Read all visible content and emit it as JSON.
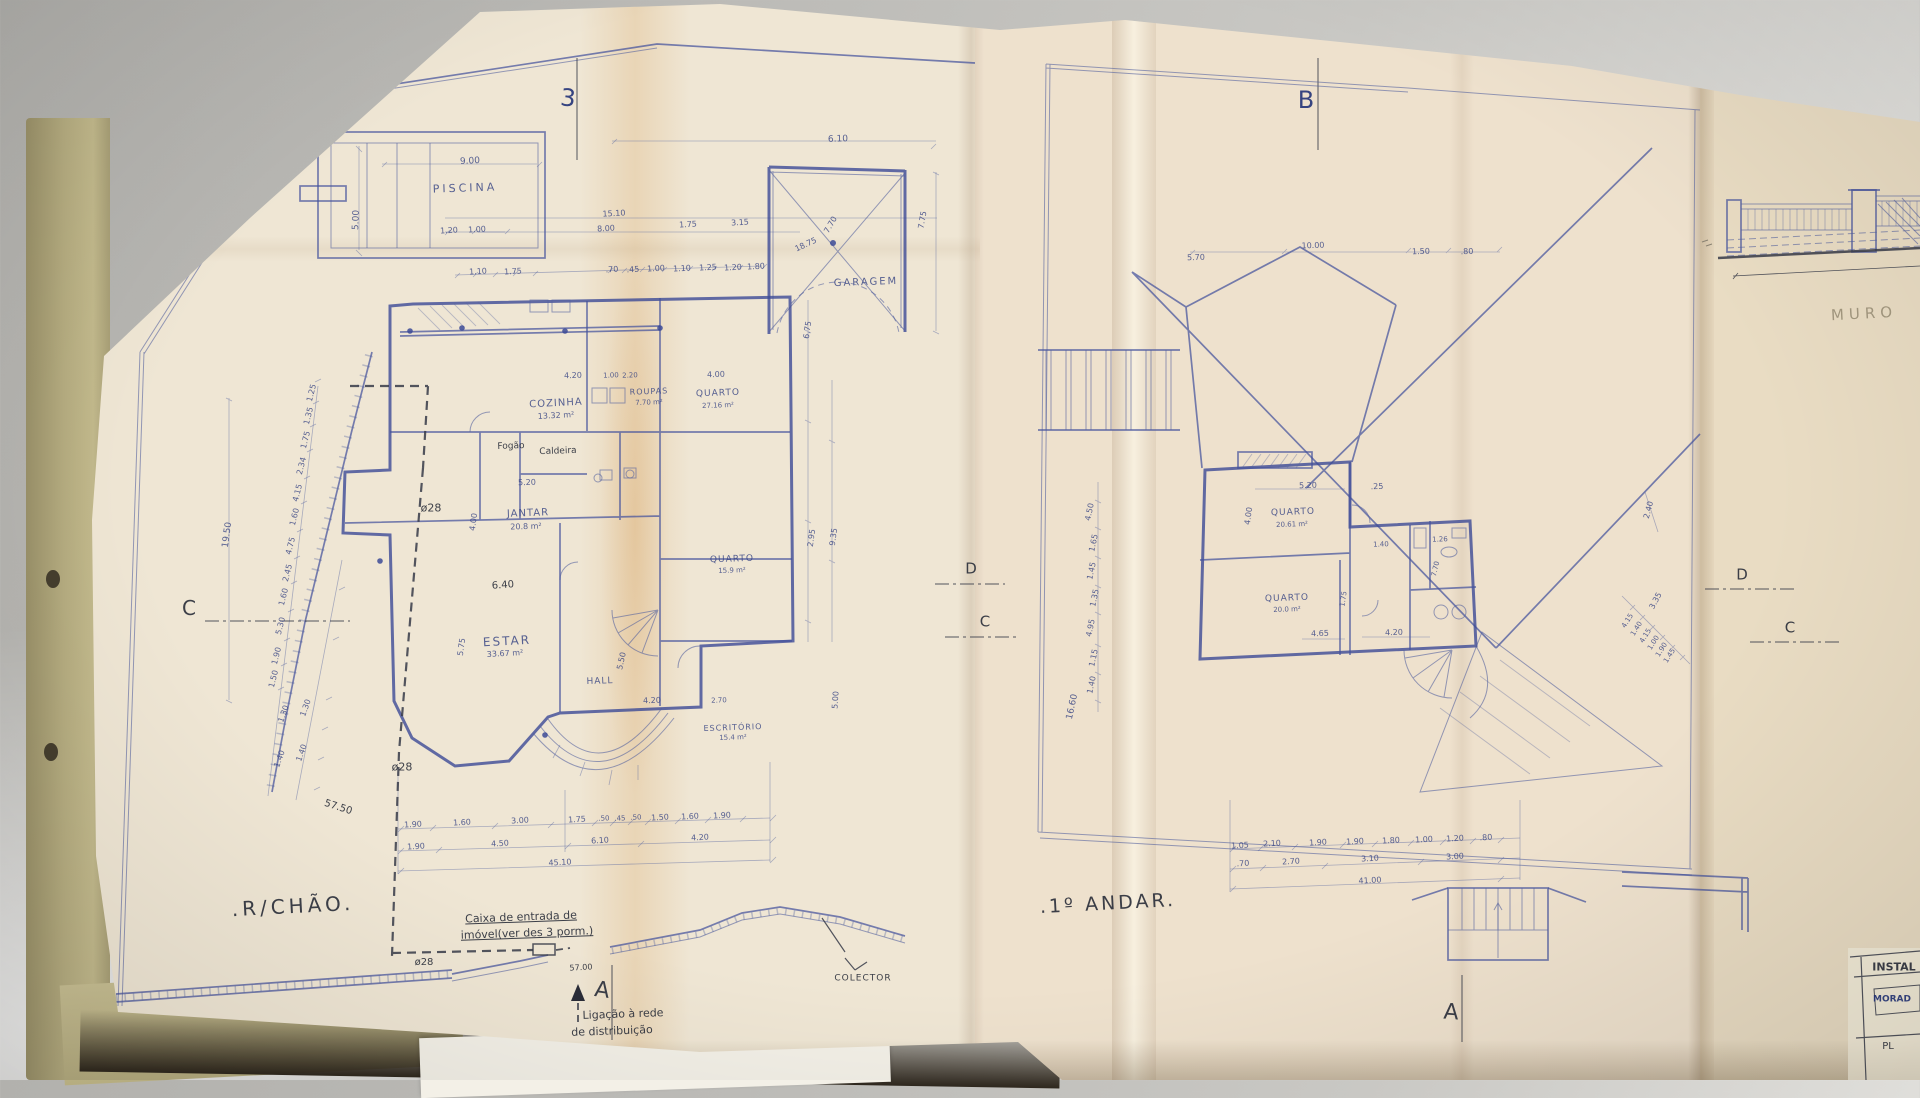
{
  "palette": {
    "paper": "#efe6d4",
    "ink_blue": "#3c4a96",
    "pen_dark": "#2a2c38",
    "fold_tint": "#d29646",
    "desk": "#c9c8c4"
  },
  "sheets": {
    "left_plan_title": ".R/CHÃO.",
    "right_plan_title": ".1º ANDAR.",
    "far_right_note": "MURO"
  },
  "annotations": [
    {
      "t": "3",
      "x": 568,
      "y": 98,
      "s": 24,
      "r": 6,
      "c": "ink2",
      "n": "section-marker-3"
    },
    {
      "t": "PISCINA",
      "x": 465,
      "y": 188,
      "s": 11,
      "r": -2,
      "ls": 3,
      "n": "room-label-piscina"
    },
    {
      "t": "9.00",
      "x": 470,
      "y": 162,
      "s": 9,
      "r": -3
    },
    {
      "t": "5.00",
      "x": 357,
      "y": 220,
      "s": 9,
      "r": -88
    },
    {
      "t": "1.20",
      "x": 449,
      "y": 231,
      "s": 8,
      "r": -3
    },
    {
      "t": "1.00",
      "x": 477,
      "y": 230,
      "s": 8,
      "r": -3
    },
    {
      "t": "15.10",
      "x": 614,
      "y": 214,
      "s": 8,
      "r": -3
    },
    {
      "t": "8.00",
      "x": 606,
      "y": 229,
      "s": 8,
      "r": -3
    },
    {
      "t": "1.75",
      "x": 688,
      "y": 225,
      "s": 8,
      "r": -3
    },
    {
      "t": "3.15",
      "x": 740,
      "y": 223,
      "s": 8,
      "r": -3
    },
    {
      "t": "1.10",
      "x": 478,
      "y": 272,
      "s": 8,
      "r": -3
    },
    {
      "t": "1.75",
      "x": 513,
      "y": 272,
      "s": 8,
      "r": -3
    },
    {
      "t": ".70",
      "x": 612,
      "y": 270,
      "s": 8,
      "r": -3
    },
    {
      "t": ".45",
      "x": 633,
      "y": 270,
      "s": 8,
      "r": -3
    },
    {
      "t": "1.00",
      "x": 656,
      "y": 269,
      "s": 8,
      "r": -3
    },
    {
      "t": "1.10",
      "x": 682,
      "y": 269,
      "s": 8,
      "r": -3
    },
    {
      "t": "1.25",
      "x": 708,
      "y": 268,
      "s": 8,
      "r": -3
    },
    {
      "t": "1.20",
      "x": 733,
      "y": 268,
      "s": 8,
      "r": -3
    },
    {
      "t": "1.80",
      "x": 756,
      "y": 267,
      "s": 8,
      "r": -3
    },
    {
      "t": "6.10",
      "x": 838,
      "y": 140,
      "s": 9,
      "r": -2
    },
    {
      "t": "GARAGEM",
      "x": 866,
      "y": 283,
      "s": 10,
      "r": -2,
      "ls": 2,
      "n": "room-label-garagem"
    },
    {
      "t": "7.75",
      "x": 923,
      "y": 220,
      "s": 8,
      "r": -80
    },
    {
      "t": "7.70",
      "x": 831,
      "y": 225,
      "s": 8,
      "r": -60
    },
    {
      "t": "18.75",
      "x": 806,
      "y": 245,
      "s": 8,
      "r": -25
    },
    {
      "t": "COZINHA",
      "x": 556,
      "y": 404,
      "s": 10,
      "r": -3,
      "ls": 1,
      "n": "room-label-cozinha"
    },
    {
      "t": "13.32 m²",
      "x": 556,
      "y": 416,
      "s": 8,
      "r": -3
    },
    {
      "t": "ROUPAS",
      "x": 649,
      "y": 392,
      "s": 8,
      "r": -2,
      "ls": 1,
      "n": "room-label-roupas"
    },
    {
      "t": "7.70 m²",
      "x": 649,
      "y": 403,
      "s": 7,
      "r": -2
    },
    {
      "t": "QUARTO",
      "x": 718,
      "y": 394,
      "s": 9,
      "r": -2,
      "ls": 1,
      "n": "room-label-quarto-1"
    },
    {
      "t": "27.16 m²",
      "x": 718,
      "y": 406,
      "s": 7,
      "r": -2
    },
    {
      "t": "4.20",
      "x": 573,
      "y": 376,
      "s": 8,
      "r": -2
    },
    {
      "t": "1.00",
      "x": 611,
      "y": 376,
      "s": 7,
      "r": -2
    },
    {
      "t": "2.20",
      "x": 630,
      "y": 376,
      "s": 7,
      "r": -2
    },
    {
      "t": "4.00",
      "x": 716,
      "y": 375,
      "s": 8,
      "r": -2
    },
    {
      "t": "Fogão",
      "x": 511,
      "y": 447,
      "s": 9,
      "r": -2,
      "c": "dark",
      "n": "note-fogao"
    },
    {
      "t": "Caldeira",
      "x": 558,
      "y": 452,
      "s": 9,
      "r": -2,
      "c": "dark",
      "n": "note-caldeira"
    },
    {
      "t": "5.20",
      "x": 527,
      "y": 483,
      "s": 8,
      "r": -2
    },
    {
      "t": "JANTAR",
      "x": 528,
      "y": 514,
      "s": 10,
      "r": -2,
      "ls": 1,
      "n": "room-label-jantar"
    },
    {
      "t": "20.8 m²",
      "x": 526,
      "y": 527,
      "s": 8,
      "r": -2
    },
    {
      "t": "ø28",
      "x": 431,
      "y": 508,
      "s": 11,
      "c": "dark"
    },
    {
      "t": "4.00",
      "x": 474,
      "y": 522,
      "s": 8,
      "r": -82
    },
    {
      "t": "6.40",
      "x": 503,
      "y": 586,
      "s": 10,
      "r": -4,
      "c": "dark"
    },
    {
      "t": "ESTAR",
      "x": 507,
      "y": 641,
      "s": 12,
      "r": -3,
      "ls": 2,
      "n": "room-label-estar"
    },
    {
      "t": "33.67 m²",
      "x": 505,
      "y": 654,
      "s": 8,
      "r": -3
    },
    {
      "t": "5.75",
      "x": 462,
      "y": 647,
      "s": 8,
      "r": -82
    },
    {
      "t": "HALL",
      "x": 600,
      "y": 682,
      "s": 9,
      "r": -2,
      "ls": 1,
      "n": "room-label-hall"
    },
    {
      "t": "5.50",
      "x": 622,
      "y": 661,
      "s": 8,
      "r": -77
    },
    {
      "t": "4.20",
      "x": 652,
      "y": 701,
      "s": 8,
      "r": -2
    },
    {
      "t": "QUARTO",
      "x": 732,
      "y": 560,
      "s": 9,
      "r": -2,
      "ls": 1,
      "n": "room-label-quarto-2"
    },
    {
      "t": "15.9 m²",
      "x": 732,
      "y": 571,
      "s": 7,
      "r": -2
    },
    {
      "t": "2.70",
      "x": 719,
      "y": 701,
      "s": 7,
      "r": -2
    },
    {
      "t": "ESCRITÓRIO",
      "x": 733,
      "y": 728,
      "s": 8,
      "r": -2,
      "ls": 1,
      "n": "room-label-escritorio"
    },
    {
      "t": "15.4 m²",
      "x": 733,
      "y": 738,
      "s": 7,
      "r": -2
    },
    {
      "t": "6.75",
      "x": 808,
      "y": 330,
      "s": 8,
      "r": -82
    },
    {
      "t": "2.95",
      "x": 812,
      "y": 538,
      "s": 8,
      "r": -82
    },
    {
      "t": "9.35",
      "x": 834,
      "y": 537,
      "s": 8,
      "r": -82
    },
    {
      "t": "5.00",
      "x": 836,
      "y": 700,
      "s": 8,
      "r": -86
    },
    {
      "t": "ø28",
      "x": 402,
      "y": 767,
      "s": 11,
      "c": "dark"
    },
    {
      "t": "ø28",
      "x": 424,
      "y": 963,
      "s": 10,
      "c": "dark"
    },
    {
      "t": "1.25",
      "x": 312,
      "y": 393,
      "s": 8,
      "r": -76
    },
    {
      "t": "1.35",
      "x": 309,
      "y": 416,
      "s": 8,
      "r": -76
    },
    {
      "t": "1.75",
      "x": 306,
      "y": 440,
      "s": 8,
      "r": -76
    },
    {
      "t": "2.34",
      "x": 302,
      "y": 466,
      "s": 8,
      "r": -76
    },
    {
      "t": "4.15",
      "x": 298,
      "y": 493,
      "s": 8,
      "r": -76
    },
    {
      "t": "1.60",
      "x": 295,
      "y": 517,
      "s": 8,
      "r": -76
    },
    {
      "t": "4.75",
      "x": 291,
      "y": 546,
      "s": 8,
      "r": -76
    },
    {
      "t": "2.45",
      "x": 288,
      "y": 573,
      "s": 8,
      "r": -76
    },
    {
      "t": "1.60",
      "x": 284,
      "y": 597,
      "s": 8,
      "r": -76
    },
    {
      "t": "5.30",
      "x": 281,
      "y": 626,
      "s": 8,
      "r": -76
    },
    {
      "t": "1.90",
      "x": 277,
      "y": 656,
      "s": 8,
      "r": -76
    },
    {
      "t": "1.50",
      "x": 274,
      "y": 679,
      "s": 8,
      "r": -76
    },
    {
      "t": "1.30",
      "x": 284,
      "y": 714,
      "s": 8,
      "r": -70
    },
    {
      "t": "1.30",
      "x": 306,
      "y": 708,
      "s": 8,
      "r": -70
    },
    {
      "t": "1.40",
      "x": 280,
      "y": 759,
      "s": 8,
      "r": -70
    },
    {
      "t": "1.40",
      "x": 302,
      "y": 753,
      "s": 8,
      "r": -70
    },
    {
      "t": "19.50",
      "x": 228,
      "y": 535,
      "s": 9,
      "r": -82
    },
    {
      "t": "57.50",
      "x": 338,
      "y": 808,
      "s": 10,
      "r": 18,
      "c": "dark"
    },
    {
      "t": "1.90",
      "x": 413,
      "y": 825,
      "s": 8,
      "r": -3
    },
    {
      "t": "1.60",
      "x": 462,
      "y": 823,
      "s": 8,
      "r": -3
    },
    {
      "t": "3.00",
      "x": 520,
      "y": 821,
      "s": 8,
      "r": -3
    },
    {
      "t": "1.75",
      "x": 577,
      "y": 820,
      "s": 8,
      "r": -3
    },
    {
      "t": ".50",
      "x": 604,
      "y": 819,
      "s": 7,
      "r": -3
    },
    {
      "t": ".45",
      "x": 620,
      "y": 819,
      "s": 7,
      "r": -3
    },
    {
      "t": ".50",
      "x": 636,
      "y": 818,
      "s": 7,
      "r": -3
    },
    {
      "t": "1.50",
      "x": 660,
      "y": 818,
      "s": 8,
      "r": -3
    },
    {
      "t": "1.60",
      "x": 690,
      "y": 817,
      "s": 8,
      "r": -3
    },
    {
      "t": "1.90",
      "x": 722,
      "y": 816,
      "s": 8,
      "r": -3
    },
    {
      "t": "1.90",
      "x": 416,
      "y": 847,
      "s": 8,
      "r": -3
    },
    {
      "t": "4.50",
      "x": 500,
      "y": 844,
      "s": 8,
      "r": -3
    },
    {
      "t": "6.10",
      "x": 600,
      "y": 841,
      "s": 8,
      "r": -3
    },
    {
      "t": "4.20",
      "x": 700,
      "y": 838,
      "s": 8,
      "r": -3
    },
    {
      "t": "45.10",
      "x": 560,
      "y": 863,
      "s": 8,
      "r": -3
    },
    {
      "t": "57.00",
      "x": 581,
      "y": 968,
      "s": 8,
      "r": -3,
      "c": "dark"
    },
    {
      "t": "C",
      "x": 189,
      "y": 608,
      "s": 20,
      "c": "dark",
      "n": "section-marker-c-left"
    },
    {
      "t": ".R/CHÃO.",
      "x": 293,
      "y": 906,
      "s": 20,
      "r": -3,
      "ls": 4,
      "c": "dark",
      "n": "sheet-title-rchao"
    },
    {
      "t": "Caixa de entrada de",
      "x": 521,
      "y": 917,
      "s": 11,
      "r": -2,
      "c": "dark",
      "u": true,
      "n": "note-caixa-line1"
    },
    {
      "t": "imóvel(ver des 3 porm.)",
      "x": 527,
      "y": 933,
      "s": 11,
      "r": -2,
      "c": "dark",
      "u": true,
      "n": "note-caixa-line2"
    },
    {
      "t": "A",
      "x": 602,
      "y": 991,
      "s": 22,
      "r": 8,
      "c": "dark",
      "n": "section-marker-a-left"
    },
    {
      "t": "Ligação à rede",
      "x": 623,
      "y": 1014,
      "s": 11,
      "r": -2,
      "c": "dark",
      "n": "note-ligacao-line1"
    },
    {
      "t": "de distribuição",
      "x": 612,
      "y": 1031,
      "s": 11,
      "r": -2,
      "c": "dark",
      "n": "note-ligacao-line2"
    },
    {
      "t": "COLECTOR",
      "x": 863,
      "y": 979,
      "s": 9,
      "ls": 1,
      "c": "dark",
      "n": "note-colector"
    },
    {
      "t": "D",
      "x": 971,
      "y": 569,
      "s": 15,
      "c": "dark",
      "n": "section-marker-d-left"
    },
    {
      "t": "C",
      "x": 985,
      "y": 622,
      "s": 15,
      "c": "dark"
    },
    {
      "t": "B",
      "x": 1306,
      "y": 100,
      "s": 24,
      "c": "ink2",
      "n": "section-marker-b"
    },
    {
      "t": "5.70",
      "x": 1196,
      "y": 258,
      "s": 8,
      "r": -2
    },
    {
      "t": "10.00",
      "x": 1313,
      "y": 246,
      "s": 8,
      "r": -2
    },
    {
      "t": "1.50",
      "x": 1421,
      "y": 252,
      "s": 8,
      "r": -2
    },
    {
      "t": ".80",
      "x": 1467,
      "y": 252,
      "s": 8,
      "r": -2
    },
    {
      "t": "QUARTO",
      "x": 1293,
      "y": 513,
      "s": 9,
      "r": -2,
      "ls": 1,
      "n": "room-label-quarto-3"
    },
    {
      "t": "20.61 m²",
      "x": 1292,
      "y": 525,
      "s": 7,
      "r": -2
    },
    {
      "t": "5.20",
      "x": 1308,
      "y": 486,
      "s": 8,
      "r": -2
    },
    {
      "t": ".25",
      "x": 1377,
      "y": 487,
      "s": 8,
      "r": -2
    },
    {
      "t": "4.00",
      "x": 1249,
      "y": 516,
      "s": 8,
      "r": -82
    },
    {
      "t": "1.40",
      "x": 1381,
      "y": 545,
      "s": 7,
      "r": -2
    },
    {
      "t": "1.26",
      "x": 1440,
      "y": 540,
      "s": 7,
      "r": -2
    },
    {
      "t": "7.70",
      "x": 1436,
      "y": 569,
      "s": 7,
      "r": -77
    },
    {
      "t": "QUARTO",
      "x": 1287,
      "y": 599,
      "s": 9,
      "r": -2,
      "ls": 1,
      "n": "room-label-quarto-4"
    },
    {
      "t": "20.0 m²",
      "x": 1287,
      "y": 610,
      "s": 7,
      "r": -2
    },
    {
      "t": "1.75",
      "x": 1344,
      "y": 599,
      "s": 7,
      "r": -82
    },
    {
      "t": "4.65",
      "x": 1320,
      "y": 634,
      "s": 8,
      "r": -2
    },
    {
      "t": "4.20",
      "x": 1394,
      "y": 633,
      "s": 8,
      "r": -2
    },
    {
      "t": "4.50",
      "x": 1090,
      "y": 512,
      "s": 8,
      "r": -78
    },
    {
      "t": "1.65",
      "x": 1094,
      "y": 543,
      "s": 8,
      "r": -78
    },
    {
      "t": "1.45",
      "x": 1092,
      "y": 571,
      "s": 8,
      "r": -78
    },
    {
      "t": "1.35",
      "x": 1095,
      "y": 598,
      "s": 8,
      "r": -78
    },
    {
      "t": "4.95",
      "x": 1091,
      "y": 628,
      "s": 8,
      "r": -78
    },
    {
      "t": "1.15",
      "x": 1094,
      "y": 658,
      "s": 8,
      "r": -78
    },
    {
      "t": "1.40",
      "x": 1092,
      "y": 685,
      "s": 8,
      "r": -78
    },
    {
      "t": "16.60",
      "x": 1073,
      "y": 707,
      "s": 9,
      "r": -78
    },
    {
      "t": "2.40",
      "x": 1649,
      "y": 510,
      "s": 8,
      "r": -75
    },
    {
      "t": "3.35",
      "x": 1656,
      "y": 601,
      "s": 8,
      "r": -62
    },
    {
      "t": "4.15",
      "x": 1628,
      "y": 621,
      "s": 7,
      "r": -58
    },
    {
      "t": "1.40",
      "x": 1637,
      "y": 629,
      "s": 7,
      "r": -58
    },
    {
      "t": "4.15",
      "x": 1646,
      "y": 636,
      "s": 7,
      "r": -58
    },
    {
      "t": "1.00",
      "x": 1654,
      "y": 643,
      "s": 7,
      "r": -58
    },
    {
      "t": "1.90",
      "x": 1662,
      "y": 650,
      "s": 7,
      "r": -58
    },
    {
      "t": "1.45",
      "x": 1670,
      "y": 656,
      "s": 7,
      "r": -58
    },
    {
      "t": "1.05",
      "x": 1240,
      "y": 846,
      "s": 8,
      "r": -3
    },
    {
      "t": "2.10",
      "x": 1272,
      "y": 844,
      "s": 8,
      "r": -3
    },
    {
      "t": "1.90",
      "x": 1318,
      "y": 843,
      "s": 8,
      "r": -3
    },
    {
      "t": "1.90",
      "x": 1355,
      "y": 842,
      "s": 8,
      "r": -3
    },
    {
      "t": "1.80",
      "x": 1391,
      "y": 841,
      "s": 8,
      "r": -3
    },
    {
      "t": "1.00",
      "x": 1424,
      "y": 840,
      "s": 8,
      "r": -3
    },
    {
      "t": "1.20",
      "x": 1455,
      "y": 839,
      "s": 8,
      "r": -3
    },
    {
      "t": ".80",
      "x": 1486,
      "y": 838,
      "s": 8,
      "r": -3
    },
    {
      "t": ".70",
      "x": 1243,
      "y": 864,
      "s": 8,
      "r": -3
    },
    {
      "t": "2.70",
      "x": 1291,
      "y": 862,
      "s": 8,
      "r": -3
    },
    {
      "t": "3.10",
      "x": 1370,
      "y": 859,
      "s": 8,
      "r": -3
    },
    {
      "t": "3.00",
      "x": 1455,
      "y": 857,
      "s": 8,
      "r": -3
    },
    {
      "t": "41.00",
      "x": 1370,
      "y": 881,
      "s": 8,
      "r": -3
    },
    {
      "t": ".1º ANDAR.",
      "x": 1108,
      "y": 904,
      "s": 19,
      "r": -3,
      "ls": 3,
      "c": "dark",
      "n": "sheet-title-1andar"
    },
    {
      "t": "A",
      "x": 1451,
      "y": 1013,
      "s": 22,
      "r": 4,
      "c": "dark",
      "n": "section-marker-a-right"
    },
    {
      "t": "D",
      "x": 1742,
      "y": 575,
      "s": 15,
      "c": "dark",
      "n": "section-marker-d-right"
    },
    {
      "t": "C",
      "x": 1790,
      "y": 628,
      "s": 15,
      "c": "dark",
      "n": "section-marker-c-right"
    },
    {
      "t": "MURO",
      "x": 1864,
      "y": 314,
      "s": 15,
      "r": -3,
      "ls": 5,
      "c": "pencil",
      "n": "note-muro"
    },
    {
      "t": "INSTAL",
      "x": 1894,
      "y": 967,
      "s": 11,
      "b": true,
      "c": "dark",
      "n": "titleblock-instal"
    },
    {
      "t": "MORAD",
      "x": 1892,
      "y": 1000,
      "s": 9,
      "b": true,
      "c": "ink2",
      "n": "titleblock-morad"
    },
    {
      "t": "PL",
      "x": 1888,
      "y": 1047,
      "s": 10,
      "c": "dark",
      "n": "titleblock-pl"
    }
  ]
}
